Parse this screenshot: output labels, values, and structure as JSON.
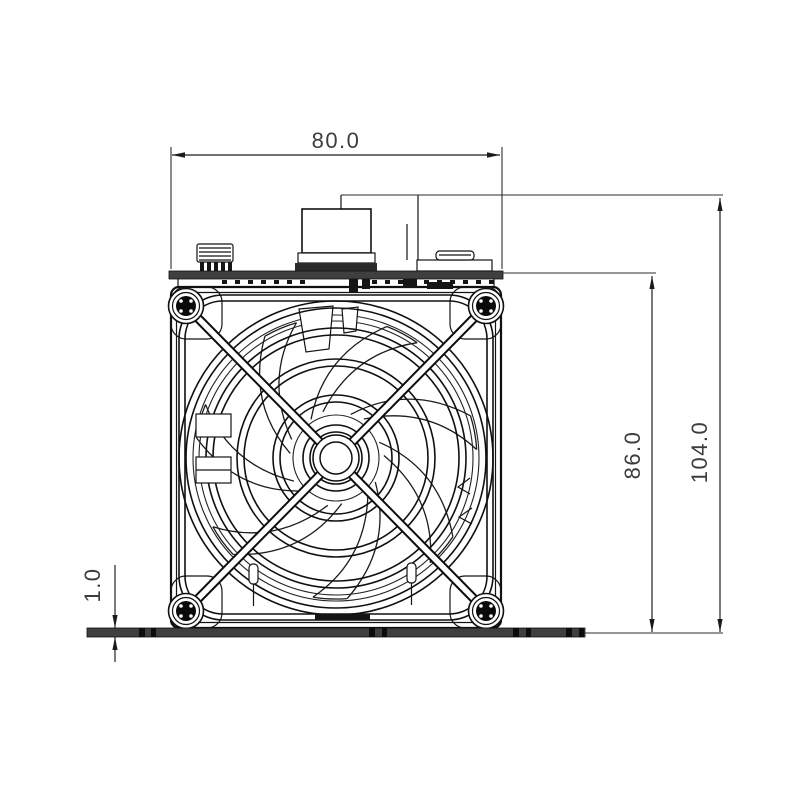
{
  "drawing": {
    "type": "technical-drawing",
    "subject": "axial-fan-heater-front-view",
    "dimensions": {
      "width": "80.0",
      "body_height": "86.0",
      "overall_height": "104.0",
      "base_plate_thickness": "1.0"
    },
    "colors": {
      "line": "#111111",
      "dimension_line": "#2e2e2e",
      "text": "#3d3d3d",
      "plate_fill": "#3f3f3f",
      "background": "#ffffff"
    }
  }
}
